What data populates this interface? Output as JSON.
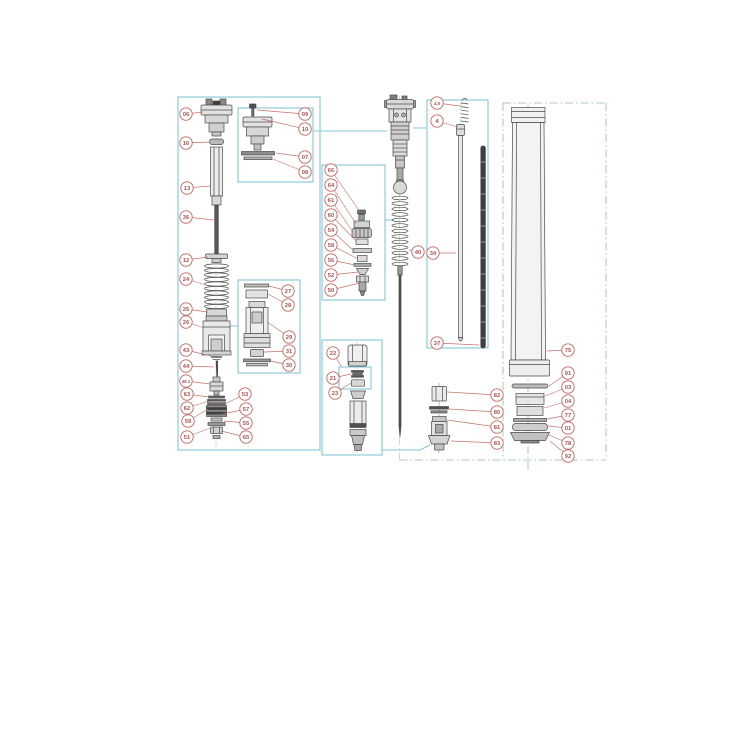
{
  "diagram": {
    "type": "exploded-parts-diagram",
    "subject": "front-fork-suspension-assembly",
    "colors": {
      "box_border": "#86c5d8",
      "callout_stroke": "#c4655f",
      "callout_text": "#b5504b",
      "leader": "#c4726e",
      "centerline": "#89ba8d",
      "part_stroke": "#4a4a4a",
      "background": "#ffffff"
    },
    "boxes": [
      {
        "name": "detail-box-left",
        "x": 178,
        "y": 97,
        "w": 142,
        "h": 353
      },
      {
        "name": "detail-box-top-cap",
        "x": 238,
        "y": 108,
        "w": 75,
        "h": 74
      },
      {
        "name": "detail-box-base-valve",
        "x": 238,
        "y": 280,
        "w": 62,
        "h": 93
      },
      {
        "name": "detail-box-adjuster",
        "x": 322,
        "y": 165,
        "w": 63,
        "h": 135
      },
      {
        "name": "detail-box-piston",
        "x": 322,
        "y": 340,
        "w": 60,
        "h": 115
      },
      {
        "name": "detail-box-shim-sub",
        "x": 339,
        "y": 367,
        "w": 32,
        "h": 22
      },
      {
        "name": "detail-box-rods",
        "x": 427,
        "y": 100,
        "w": 61,
        "h": 248
      }
    ],
    "connectors": [
      {
        "name": "link-top-cap-box",
        "points": [
          [
            313,
            131
          ],
          [
            387,
            131
          ]
        ]
      },
      {
        "name": "link-rod-box",
        "points": [
          [
            413,
            128
          ],
          [
            427,
            128
          ]
        ]
      },
      {
        "name": "link-adjuster-box",
        "points": [
          [
            385,
            220
          ],
          [
            393,
            220
          ]
        ]
      },
      {
        "name": "link-base-valve-box",
        "points": [
          [
            229,
            326
          ],
          [
            238,
            326
          ]
        ]
      },
      {
        "name": "link-piston-box",
        "points": [
          [
            382,
            450
          ],
          [
            420,
            450
          ],
          [
            430,
            445
          ]
        ]
      }
    ],
    "center_lines": [
      {
        "name": "axis-left-assembly",
        "x1": 216,
        "y1": 100,
        "x2": 216,
        "y2": 447,
        "faint": true
      },
      {
        "name": "axis-piston-detail",
        "x1": 357,
        "y1": 342,
        "x2": 357,
        "y2": 453,
        "faint": true
      },
      {
        "name": "axis-main-cartridge",
        "x1": 399.5,
        "y1": 96,
        "x2": 399.5,
        "y2": 460,
        "faint": true
      },
      {
        "name": "axis-bottom-fitting",
        "x1": 439,
        "y1": 383,
        "x2": 439,
        "y2": 455,
        "faint": false
      },
      {
        "name": "axis-push-rod",
        "x1": 460.6,
        "y1": 102,
        "x2": 460.6,
        "y2": 346,
        "faint": true
      },
      {
        "name": "axis-outer-tube",
        "x1": 528,
        "y1": 105,
        "x2": 528,
        "y2": 470,
        "faint": false
      },
      {
        "name": "frame-right-left",
        "x1": 503,
        "y1": 103,
        "x2": 503,
        "y2": 460,
        "faint": false
      },
      {
        "name": "frame-right-top",
        "x1": 503,
        "y1": 103,
        "x2": 606,
        "y2": 103,
        "faint": false
      },
      {
        "name": "frame-right-right",
        "x1": 606,
        "y1": 103,
        "x2": 606,
        "y2": 460,
        "faint": false
      },
      {
        "name": "frame-right-bottom",
        "x1": 399.5,
        "y1": 460,
        "x2": 606,
        "y2": 460,
        "faint": false
      }
    ],
    "callouts": [
      {
        "label": "06",
        "cx": 186,
        "cy": 114,
        "tx": 203,
        "ty": 112
      },
      {
        "label": "16",
        "cx": 186,
        "cy": 143,
        "tx": 210,
        "ty": 142
      },
      {
        "label": "13",
        "cx": 187,
        "cy": 188,
        "tx": 210,
        "ty": 186
      },
      {
        "label": "36",
        "cx": 186,
        "cy": 217,
        "tx": 214,
        "ty": 220
      },
      {
        "label": "12",
        "cx": 186,
        "cy": 260,
        "tx": 208,
        "ty": 257
      },
      {
        "label": "24",
        "cx": 186,
        "cy": 279,
        "tx": 206,
        "ty": 285
      },
      {
        "label": "25",
        "cx": 186,
        "cy": 309,
        "tx": 208,
        "ty": 312
      },
      {
        "label": "26",
        "cx": 186,
        "cy": 322,
        "tx": 204,
        "ty": 328
      },
      {
        "label": "43",
        "cx": 186,
        "cy": 350,
        "tx": 211,
        "ty": 356
      },
      {
        "label": "44",
        "cx": 186,
        "cy": 366,
        "tx": 214,
        "ty": 367
      },
      {
        "label": "49.1",
        "cx": 186,
        "cy": 381,
        "tx": 210,
        "ty": 384
      },
      {
        "label": "63",
        "cx": 187,
        "cy": 394,
        "tx": 209,
        "ty": 397
      },
      {
        "label": "62",
        "cx": 187,
        "cy": 408,
        "tx": 209,
        "ty": 401
      },
      {
        "label": "59",
        "cx": 188,
        "cy": 421,
        "tx": 208,
        "ty": 409
      },
      {
        "label": "51",
        "cx": 187,
        "cy": 437,
        "tx": 210,
        "ty": 428
      },
      {
        "label": "53",
        "cx": 245,
        "cy": 394,
        "tx": 225,
        "ty": 404
      },
      {
        "label": "57",
        "cx": 246,
        "cy": 409,
        "tx": 223,
        "ty": 414
      },
      {
        "label": "55",
        "cx": 246,
        "cy": 423,
        "tx": 224,
        "ty": 421
      },
      {
        "label": "65",
        "cx": 246,
        "cy": 437,
        "tx": 221,
        "ty": 431
      },
      {
        "label": "09",
        "cx": 305,
        "cy": 114,
        "tx": 257,
        "ty": 110
      },
      {
        "label": "10",
        "cx": 305,
        "cy": 129,
        "tx": 262,
        "ty": 119
      },
      {
        "label": "07",
        "cx": 305,
        "cy": 157,
        "tx": 276,
        "ty": 153
      },
      {
        "label": "08",
        "cx": 305,
        "cy": 172,
        "tx": 273,
        "ty": 159
      },
      {
        "label": "27",
        "cx": 288,
        "cy": 291,
        "tx": 269,
        "ty": 286
      },
      {
        "label": "28",
        "cx": 288,
        "cy": 305,
        "tx": 268,
        "ty": 294
      },
      {
        "label": "29",
        "cx": 289,
        "cy": 337,
        "tx": 267,
        "ty": 322
      },
      {
        "label": "31",
        "cx": 289,
        "cy": 351,
        "tx": 264,
        "ty": 352
      },
      {
        "label": "30",
        "cx": 289,
        "cy": 365,
        "tx": 271,
        "ty": 361
      },
      {
        "label": "66",
        "cx": 331,
        "cy": 170,
        "tx": 360,
        "ty": 212
      },
      {
        "label": "64",
        "cx": 331,
        "cy": 185,
        "tx": 356,
        "ty": 224
      },
      {
        "label": "61",
        "cx": 331,
        "cy": 200,
        "tx": 353,
        "ty": 232
      },
      {
        "label": "60",
        "cx": 331,
        "cy": 215,
        "tx": 356,
        "ty": 241
      },
      {
        "label": "54",
        "cx": 331,
        "cy": 230,
        "tx": 354,
        "ty": 251
      },
      {
        "label": "58",
        "cx": 331,
        "cy": 245,
        "tx": 358,
        "ty": 259
      },
      {
        "label": "56",
        "cx": 331,
        "cy": 260,
        "tx": 355,
        "ty": 265
      },
      {
        "label": "52",
        "cx": 331,
        "cy": 275,
        "tx": 358,
        "ty": 272
      },
      {
        "label": "50",
        "cx": 331,
        "cy": 290,
        "tx": 360,
        "ty": 283
      },
      {
        "label": "22",
        "cx": 333,
        "cy": 353,
        "tx": 341,
        "ty": 366
      },
      {
        "label": "21",
        "cx": 333,
        "cy": 378,
        "tx": 351,
        "ty": 374
      },
      {
        "label": "23",
        "cx": 335,
        "cy": 393,
        "tx": 351,
        "ty": 383
      },
      {
        "label": "40",
        "cx": 418,
        "cy": 252,
        "tx": 409,
        "ty": 250
      },
      {
        "label": "4.5",
        "cx": 437,
        "cy": 103,
        "tx": 460,
        "ty": 106
      },
      {
        "label": "4",
        "cx": 437,
        "cy": 121,
        "tx": 458,
        "ty": 127
      },
      {
        "label": "34",
        "cx": 433,
        "cy": 253,
        "tx": 456,
        "ty": 253
      },
      {
        "label": "37",
        "cx": 437,
        "cy": 343,
        "tx": 479,
        "ty": 345
      },
      {
        "label": "82",
        "cx": 497,
        "cy": 395,
        "tx": 447,
        "ty": 392
      },
      {
        "label": "80",
        "cx": 497,
        "cy": 412,
        "tx": 449,
        "ty": 409
      },
      {
        "label": "81",
        "cx": 497,
        "cy": 427,
        "tx": 447,
        "ty": 420
      },
      {
        "label": "83",
        "cx": 497,
        "cy": 443,
        "tx": 451,
        "ty": 441
      },
      {
        "label": "75",
        "cx": 568,
        "cy": 350,
        "tx": 547,
        "ty": 351
      },
      {
        "label": "91",
        "cx": 568,
        "cy": 373,
        "tx": 549,
        "ty": 386
      },
      {
        "label": "03",
        "cx": 568,
        "cy": 387,
        "tx": 545,
        "ty": 396
      },
      {
        "label": "04",
        "cx": 568,
        "cy": 401,
        "tx": 544,
        "ty": 408
      },
      {
        "label": "77",
        "cx": 568,
        "cy": 415,
        "tx": 547,
        "ty": 419
      },
      {
        "label": "01",
        "cx": 568,
        "cy": 428,
        "tx": 548,
        "ty": 426
      },
      {
        "label": "78",
        "cx": 568,
        "cy": 443,
        "tx": 549,
        "ty": 435
      },
      {
        "label": "92",
        "cx": 568,
        "cy": 456,
        "tx": 550,
        "ty": 441
      }
    ]
  }
}
